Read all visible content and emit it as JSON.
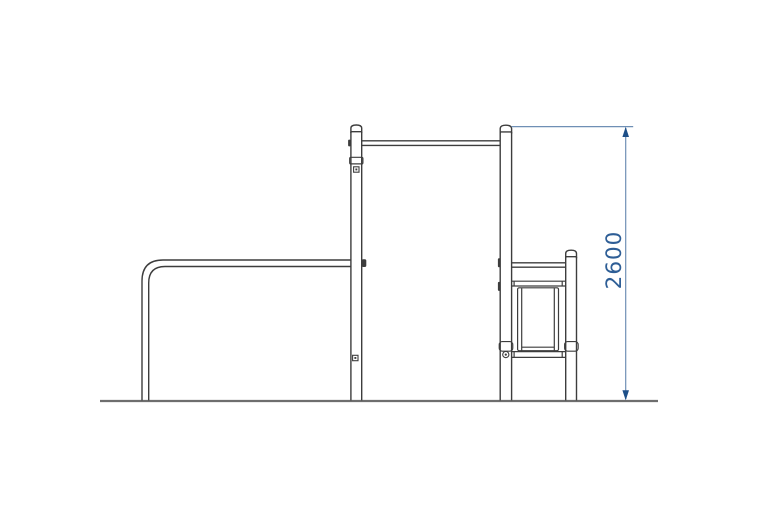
{
  "figure": {
    "type": "technical-drawing",
    "dimension": {
      "label": "2600"
    },
    "colors": {
      "outline": "#3d3d3d",
      "ground": "#6e6e6e",
      "dimension_line": "#6f8fb5",
      "dimension_arrow": "#1d4f88",
      "dimension_text": "#2e5e96",
      "background": "#ffffff"
    }
  }
}
